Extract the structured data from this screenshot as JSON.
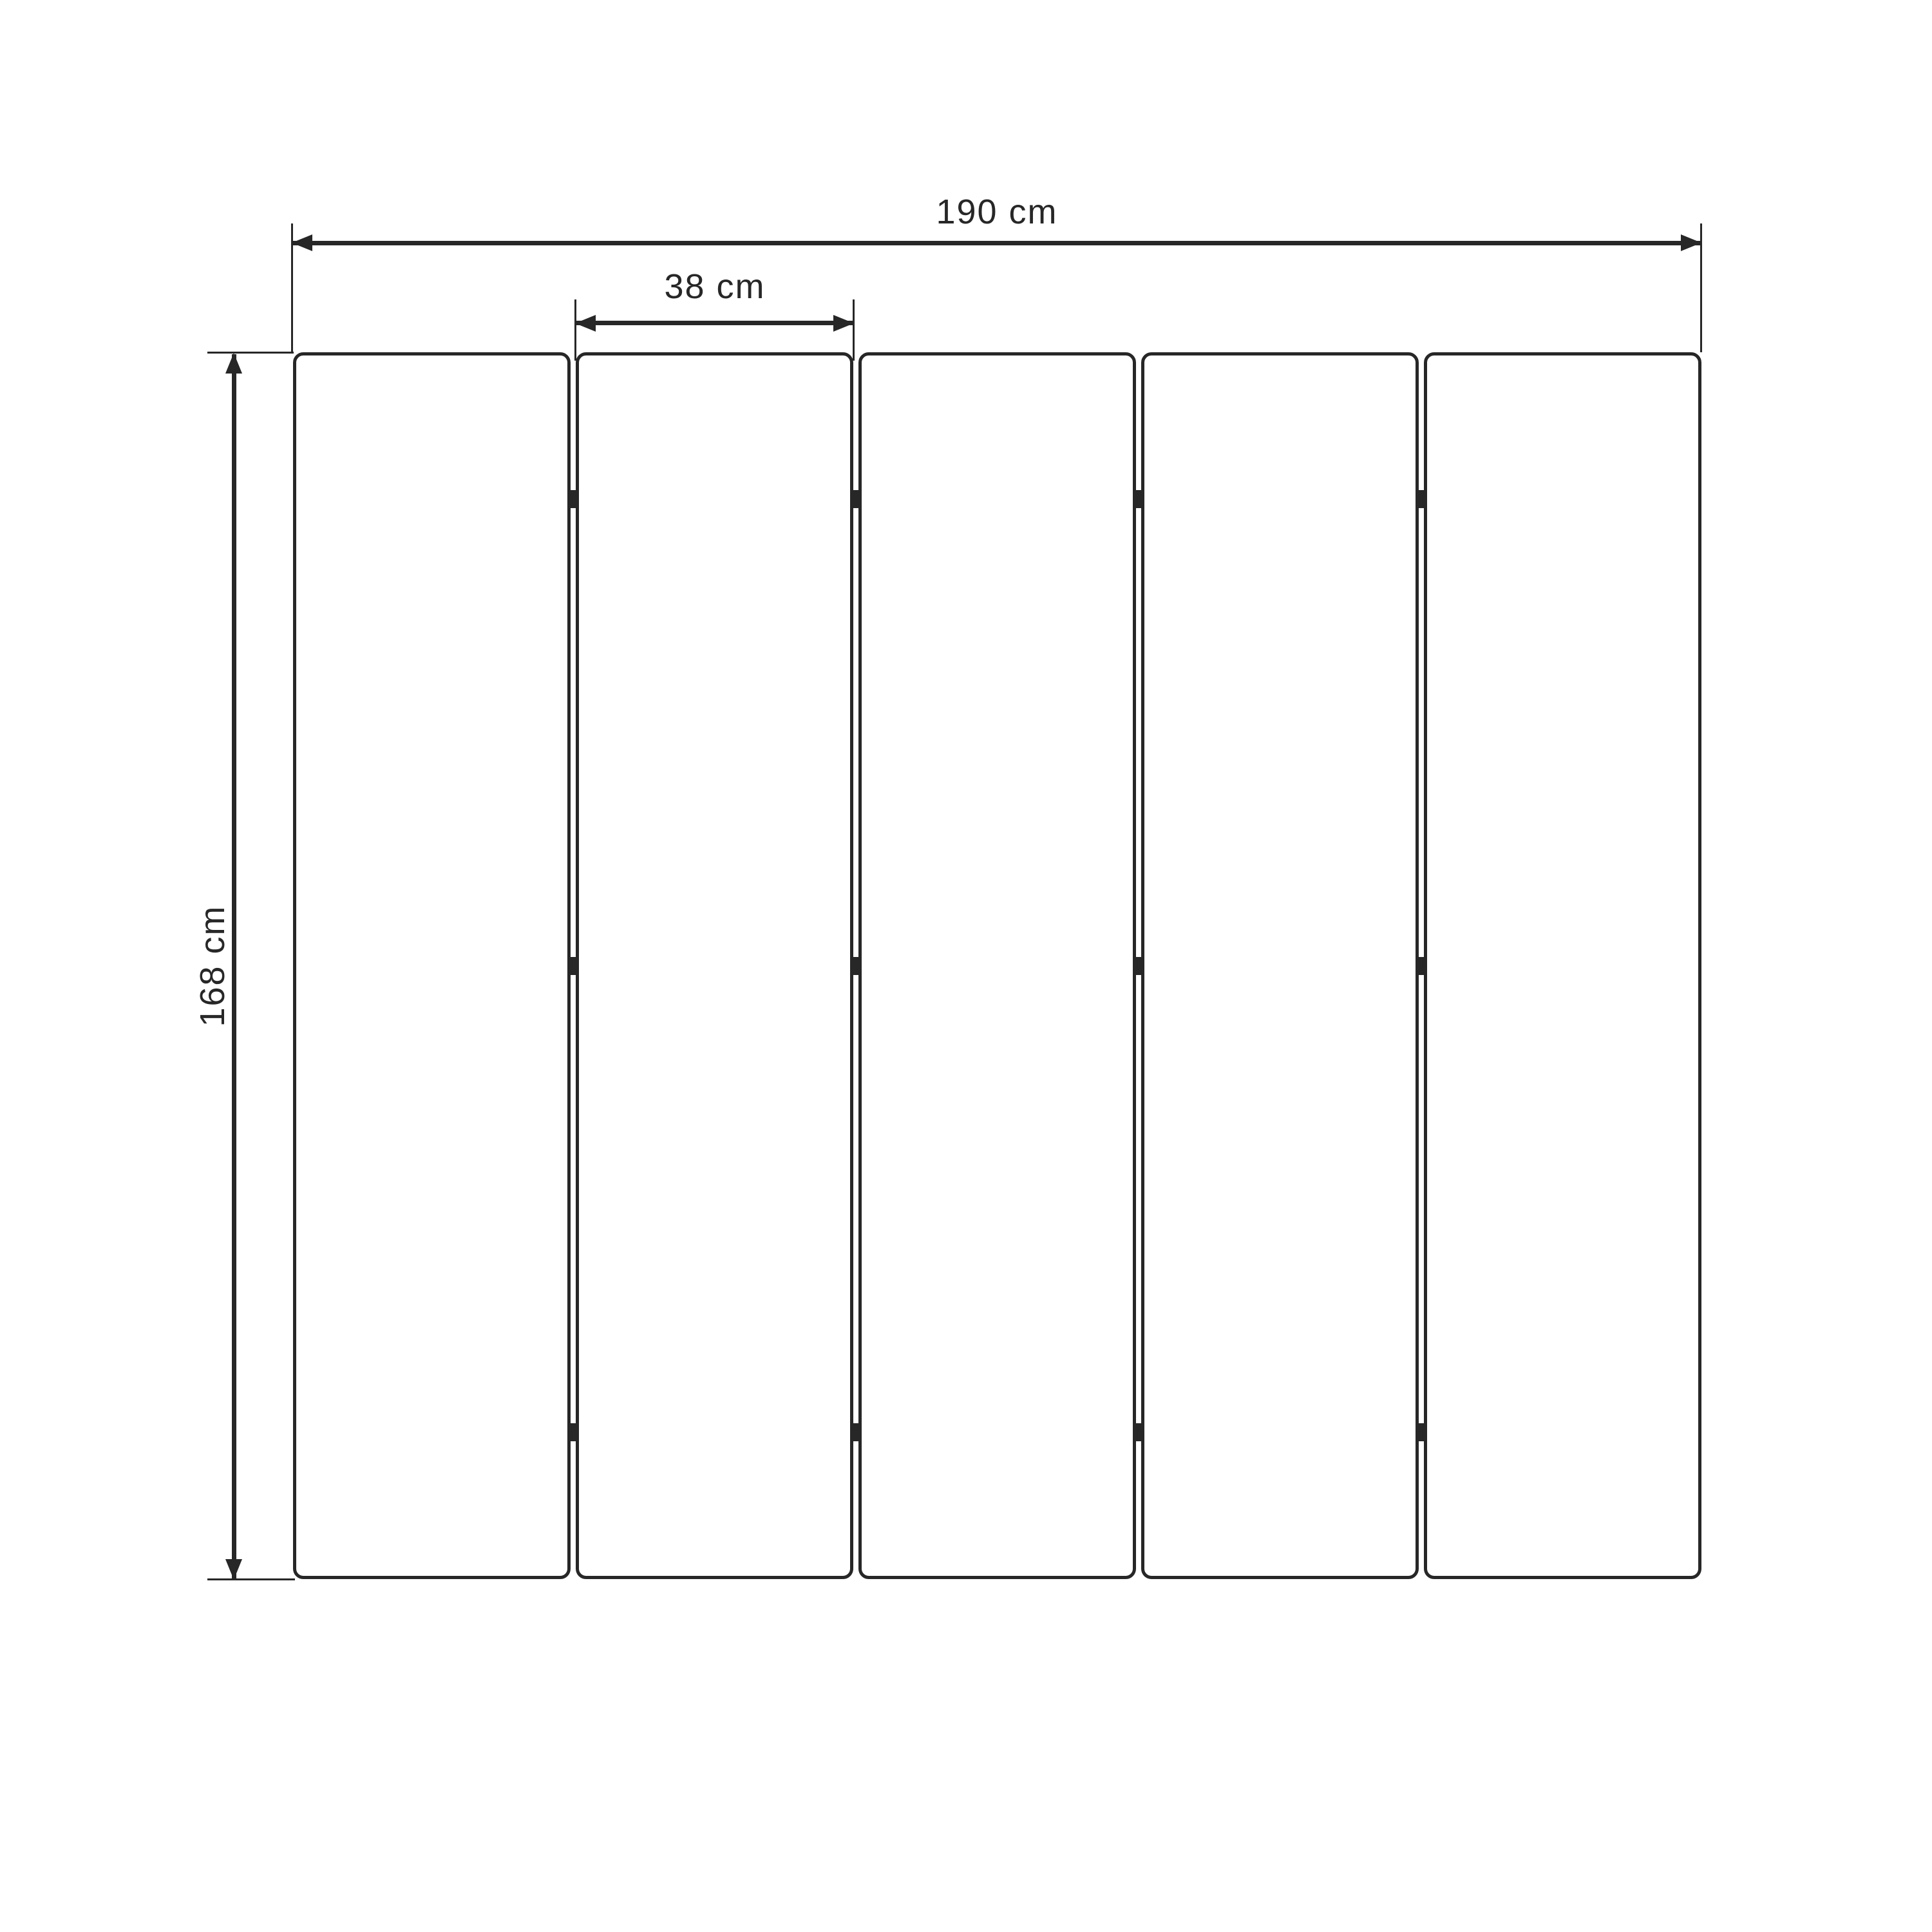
{
  "drawing": {
    "subject": "five-panel folding screen, front elevation",
    "background_color": "#ffffff",
    "line_color": "#272727",
    "panels": {
      "count": 5,
      "joints": 4,
      "hinges_per_joint": 3
    },
    "dimensions": {
      "total_width": {
        "label": "190 cm",
        "value": 190,
        "unit": "cm"
      },
      "panel_width": {
        "label": "38 cm",
        "value": 38,
        "unit": "cm"
      },
      "height": {
        "label": "168 cm",
        "value": 168,
        "unit": "cm"
      }
    }
  }
}
